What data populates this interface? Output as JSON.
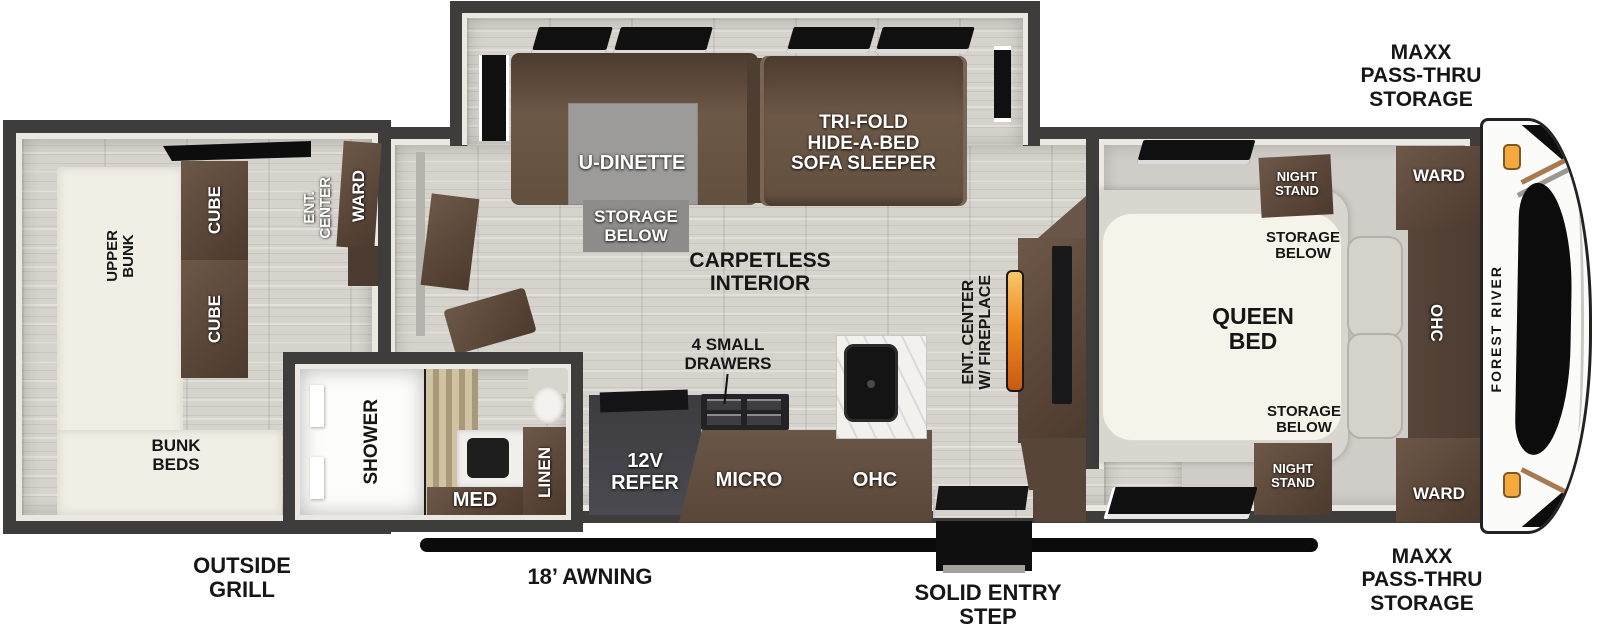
{
  "brand": {
    "front_cap_logo": "FOREST RIVER"
  },
  "colors": {
    "wall": "#3e3d3c",
    "wood_floor": "#d6d3cd",
    "cabinet_brown": "#5e4b3d",
    "bunk_cream": "#f1eee5",
    "flame_accent": "#ef8c21",
    "marker_light": "#f4a83e"
  },
  "exterior": {
    "storage_label_top": [
      "MAXX",
      "PASS-THRU",
      "STORAGE"
    ],
    "storage_label_bottom": [
      "MAXX",
      "PASS-THRU",
      "STORAGE"
    ],
    "outside_grill": [
      "OUTSIDE",
      "GRILL"
    ],
    "awning": "18’ AWNING",
    "entry_step": [
      "SOLID ENTRY",
      "STEP"
    ]
  },
  "bunk_room": {
    "upper_bunk": [
      "UPPER",
      "BUNK"
    ],
    "bunk_beds": [
      "BUNK",
      "BEDS"
    ],
    "cube_rear": "CUBE",
    "cube_front": "CUBE",
    "ent_center": [
      "ENT.",
      "CENTER"
    ],
    "ward": "WARD"
  },
  "bathroom": {
    "shower": "SHOWER",
    "med": "MED",
    "linen": "LINEN"
  },
  "living_area": {
    "dinette": "U-DINETTE",
    "dinette_storage": [
      "STORAGE",
      "BELOW"
    ],
    "sofa": [
      "TRI-FOLD",
      "HIDE-A-BED",
      "SOFA SLEEPER"
    ],
    "flooring": [
      "CARPETLESS",
      "INTERIOR"
    ],
    "entertainment": [
      "ENT. CENTER",
      "W/ FIREPLACE"
    ]
  },
  "kitchen": {
    "drawers": [
      "4 SMALL",
      "DRAWERS"
    ],
    "refrigerator": [
      "12V",
      "REFER"
    ],
    "microwave": "MICRO",
    "overhead_cabinet": "OHC"
  },
  "bedroom": {
    "night_stand_top": [
      "NIGHT",
      "STAND"
    ],
    "storage_below_top": [
      "STORAGE",
      "BELOW"
    ],
    "queen_bed": [
      "QUEEN",
      "BED"
    ],
    "storage_below_bottom": [
      "STORAGE",
      "BELOW"
    ],
    "night_stand_bottom": [
      "NIGHT",
      "STAND"
    ],
    "ward_top": "WARD",
    "ward_bottom": "WARD",
    "overhead_cabinet": "OHC"
  }
}
